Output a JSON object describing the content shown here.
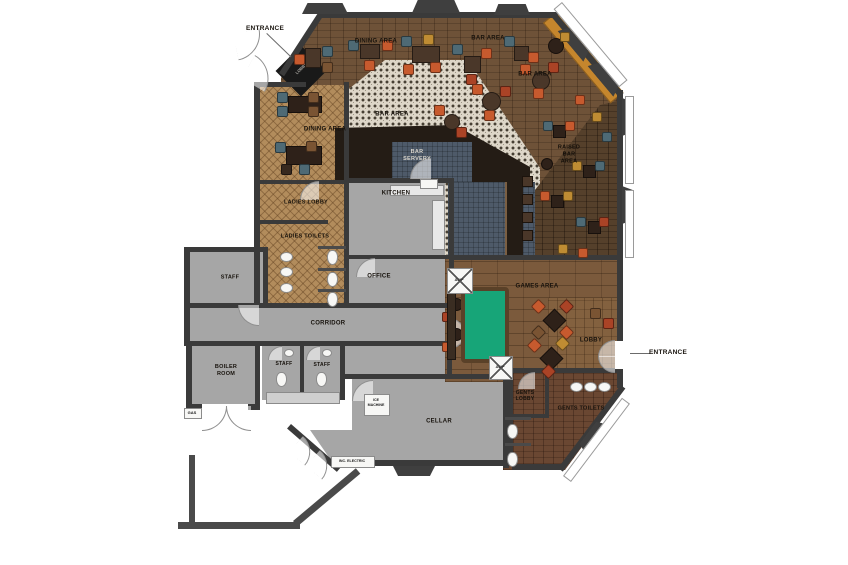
{
  "plan": {
    "title": "Pub ground floor plan",
    "room_labels": [
      {
        "name": "dining-area-top",
        "text": "DINING AREA",
        "x": 376,
        "y": 42,
        "fs": 6
      },
      {
        "name": "bar-area-top",
        "text": "BAR AREA",
        "x": 488,
        "y": 39,
        "fs": 6
      },
      {
        "name": "bar-area-right",
        "text": "BAR AREA",
        "x": 535,
        "y": 75,
        "fs": 6
      },
      {
        "name": "dining-area-left",
        "text": "DINING AREA",
        "x": 325,
        "y": 130,
        "fs": 6
      },
      {
        "name": "bar-area-mid",
        "text": "BAR AREA",
        "x": 392,
        "y": 115,
        "fs": 6
      },
      {
        "name": "bar-servery",
        "text": "BAR\nSERVERY",
        "x": 417,
        "y": 156,
        "fs": 5.5,
        "color": "#d8d4cc"
      },
      {
        "name": "raised-bar-area",
        "text": "RAISED\nBAR\nAREA",
        "x": 569,
        "y": 155,
        "fs": 5.5,
        "color": "#120d08"
      },
      {
        "name": "ladies-lobby",
        "text": "LADIES LOBBY",
        "x": 306,
        "y": 203,
        "fs": 5.5
      },
      {
        "name": "kitchen",
        "text": "KITCHEN",
        "x": 396,
        "y": 194,
        "fs": 6
      },
      {
        "name": "ladies-toilets",
        "text": "LADIES TOILETS",
        "x": 305,
        "y": 237,
        "fs": 5.5
      },
      {
        "name": "staff-room",
        "text": "STAFF",
        "x": 230,
        "y": 278,
        "fs": 5.5
      },
      {
        "name": "office",
        "text": "OFFICE",
        "x": 379,
        "y": 277,
        "fs": 6
      },
      {
        "name": "games-area",
        "text": "GAMES AREA",
        "x": 537,
        "y": 287,
        "fs": 6
      },
      {
        "name": "corridor",
        "text": "CORRIDOR",
        "x": 328,
        "y": 324,
        "fs": 6
      },
      {
        "name": "lobby-right",
        "text": "LOBBY",
        "x": 591,
        "y": 341,
        "fs": 6
      },
      {
        "name": "boiler-room",
        "text": "BOILER\nROOM",
        "x": 226,
        "y": 371,
        "fs": 5.5
      },
      {
        "name": "staff-wc-1",
        "text": "STAFF",
        "x": 284,
        "y": 364,
        "fs": 5
      },
      {
        "name": "staff-wc-2",
        "text": "STAFF",
        "x": 322,
        "y": 365,
        "fs": 5
      },
      {
        "name": "gents-lobby",
        "text": "GENTS\nLOBBY",
        "x": 525,
        "y": 396,
        "fs": 5
      },
      {
        "name": "gents-toilets",
        "text": "GENTS TOILETS",
        "x": 581,
        "y": 409,
        "fs": 5.5
      },
      {
        "name": "cellar",
        "text": "CELLAR",
        "x": 439,
        "y": 422,
        "fs": 6
      }
    ],
    "annotations": [
      {
        "name": "entrance-top",
        "text": "ENTRANCE",
        "x": 265,
        "y": 29,
        "fs": 6.5
      },
      {
        "name": "entrance-right",
        "text": "ENTRANCE",
        "x": 668,
        "y": 353,
        "fs": 6.5
      }
    ],
    "equipment": {
      "awp_machine": "AWP",
      "ice_machine": "ICE\nMACHINE",
      "gas_meter": "GAS",
      "incoming_electric": "INC. ELECTRIC",
      "entrance_vestibule": "LOBBY"
    },
    "colors": {
      "wall": "#3a3a3a",
      "wood_floor": "#6e5238",
      "raised_bar_floor": "#55402b",
      "games_floor": "#7b5a3c",
      "gents_floor": "#6a4732",
      "herringbone": "#b28c5c",
      "tile": "#ddd6c8",
      "back_of_house": "#a6a6a6",
      "servery_counter": "#241c15",
      "servery_floor": "#4e5a69",
      "bench_amber": "#c5862d",
      "pool_table": "#17a578",
      "chair_orange": "#c75a2e",
      "chair_red": "#aa4326",
      "chair_teal": "#4e6a75",
      "chair_mustard": "#bf8c33",
      "chair_brown": "#7a5433"
    }
  }
}
